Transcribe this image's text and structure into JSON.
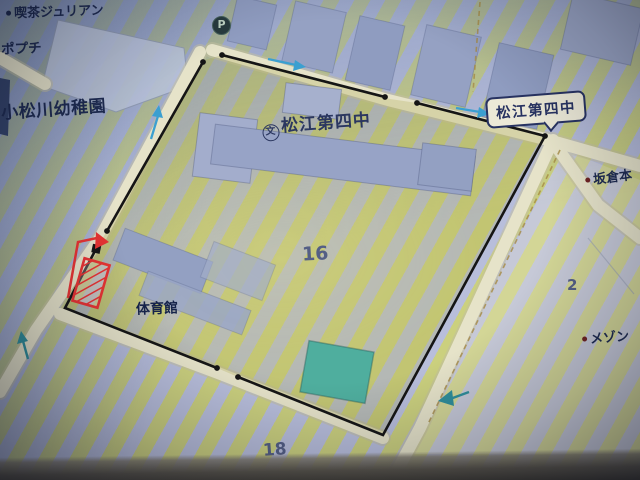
{
  "poi": {
    "cafe": "喫茶ジュリアン",
    "popuchi": "ポプチ",
    "kindergarten": "小松川幼稚園",
    "school_name": "松江第四中",
    "school_sign": "松江第四中",
    "sakakura": "坂倉本",
    "maison": "メゾン",
    "gym": "体育館"
  },
  "parcel_numbers": {
    "school_block": "16",
    "south_block": "18",
    "east_block": "2"
  },
  "icons": {
    "parking": "P",
    "school_symbol": "文"
  },
  "colors": {
    "boundary_black": "#151515",
    "annotation_red": "#e63333",
    "arrow_blue": "#3b9fd0",
    "arrow_teal": "#2f8e9a",
    "road_cream": "#e6e3c9",
    "building_blue": "#97a3c6",
    "pool_teal": "#4fae9e",
    "ink_navy": "#1d2a50",
    "sign_navy": "#273261",
    "stripe_yellow": "#cbd07e",
    "stripe_blue": "#b8bedb"
  }
}
